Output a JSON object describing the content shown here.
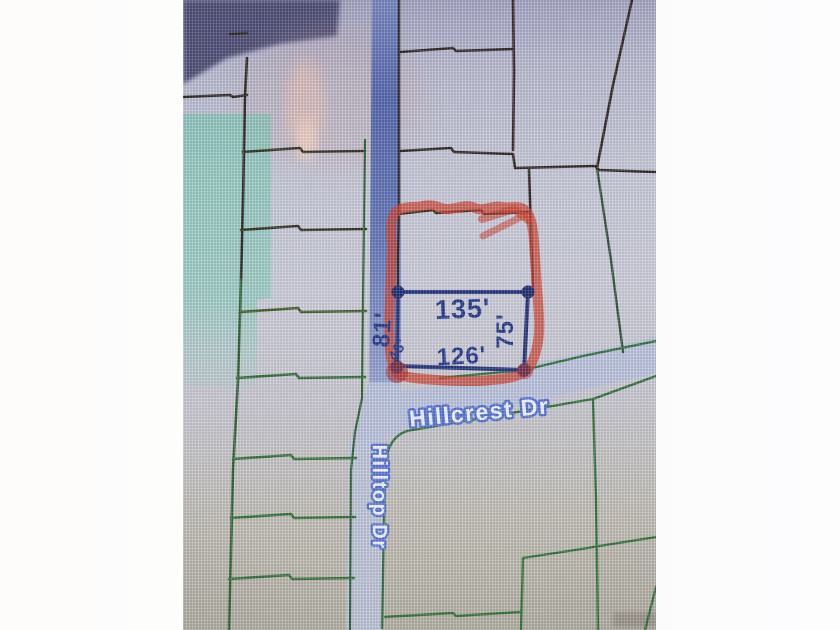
{
  "map": {
    "streets": {
      "hillcrest": "Hillcrest Dr",
      "hilltop": "Hilltop Dr"
    },
    "parcel_dimensions": {
      "top": "135'",
      "bottom": "126'",
      "right": "75'",
      "left": "81'",
      "corner": "43'"
    },
    "colors": {
      "highlight_marker": "#cb3a26",
      "measure_line": "#223379",
      "measure_dot": "#1b2c6d",
      "road_fill": "#4a5ea9",
      "road_pale_fill": "#b7c1db",
      "parcel_line_green": "#2f7036",
      "parcel_line_black": "#2b241e",
      "selection_overlay": "#69c8aa"
    }
  }
}
